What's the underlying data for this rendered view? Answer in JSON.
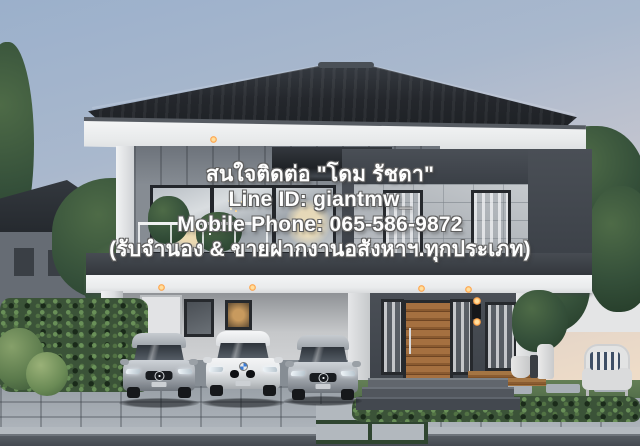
{
  "watermark": {
    "line1": "สนใจติดต่อ \"โดม รัชดา\"",
    "line2": "Line ID: giantmw_",
    "line3": "Mobile Phone: 065-586-9872",
    "line4": "(รับจำนอง & ขายฝากงานอสังหาฯ.ทุกประเภท)"
  },
  "scene": {
    "subject": "Modern two-storey detached house at dusk with stone-clad facade, glass balcony, carport with three parked cars and landscaped garden",
    "objects": [
      "dark hip roof",
      "grey vertical-panel upper wall",
      "stone tile feature wall with charcoal frame",
      "glass balcony railing",
      "white fascia band with downlights",
      "carport",
      "silver mercedes sedan",
      "white bmw coupe",
      "silver mercedes sedan",
      "wooden slat entrance door",
      "charcoal entrance wall with sconce",
      "white wicker garden chair with striped pillow",
      "tall white planters",
      "green hedges and trees",
      "stone paver driveway",
      "neighbour houses"
    ],
    "colors": {
      "sky_top": "#9bb0cb",
      "sky_horizon": "#eedcc8",
      "roof": "#26292e",
      "upper_wall": "#868c93",
      "stone_wall": "#b7bbc0",
      "charcoal_accent": "#3e434a",
      "fascia_white": "#f0f1f2",
      "door_wood": "#8a5c31",
      "foliage": "#3b5338",
      "paver": "#a3aab1",
      "road": "#4a5057",
      "watermark_text": "#fefefe"
    }
  }
}
